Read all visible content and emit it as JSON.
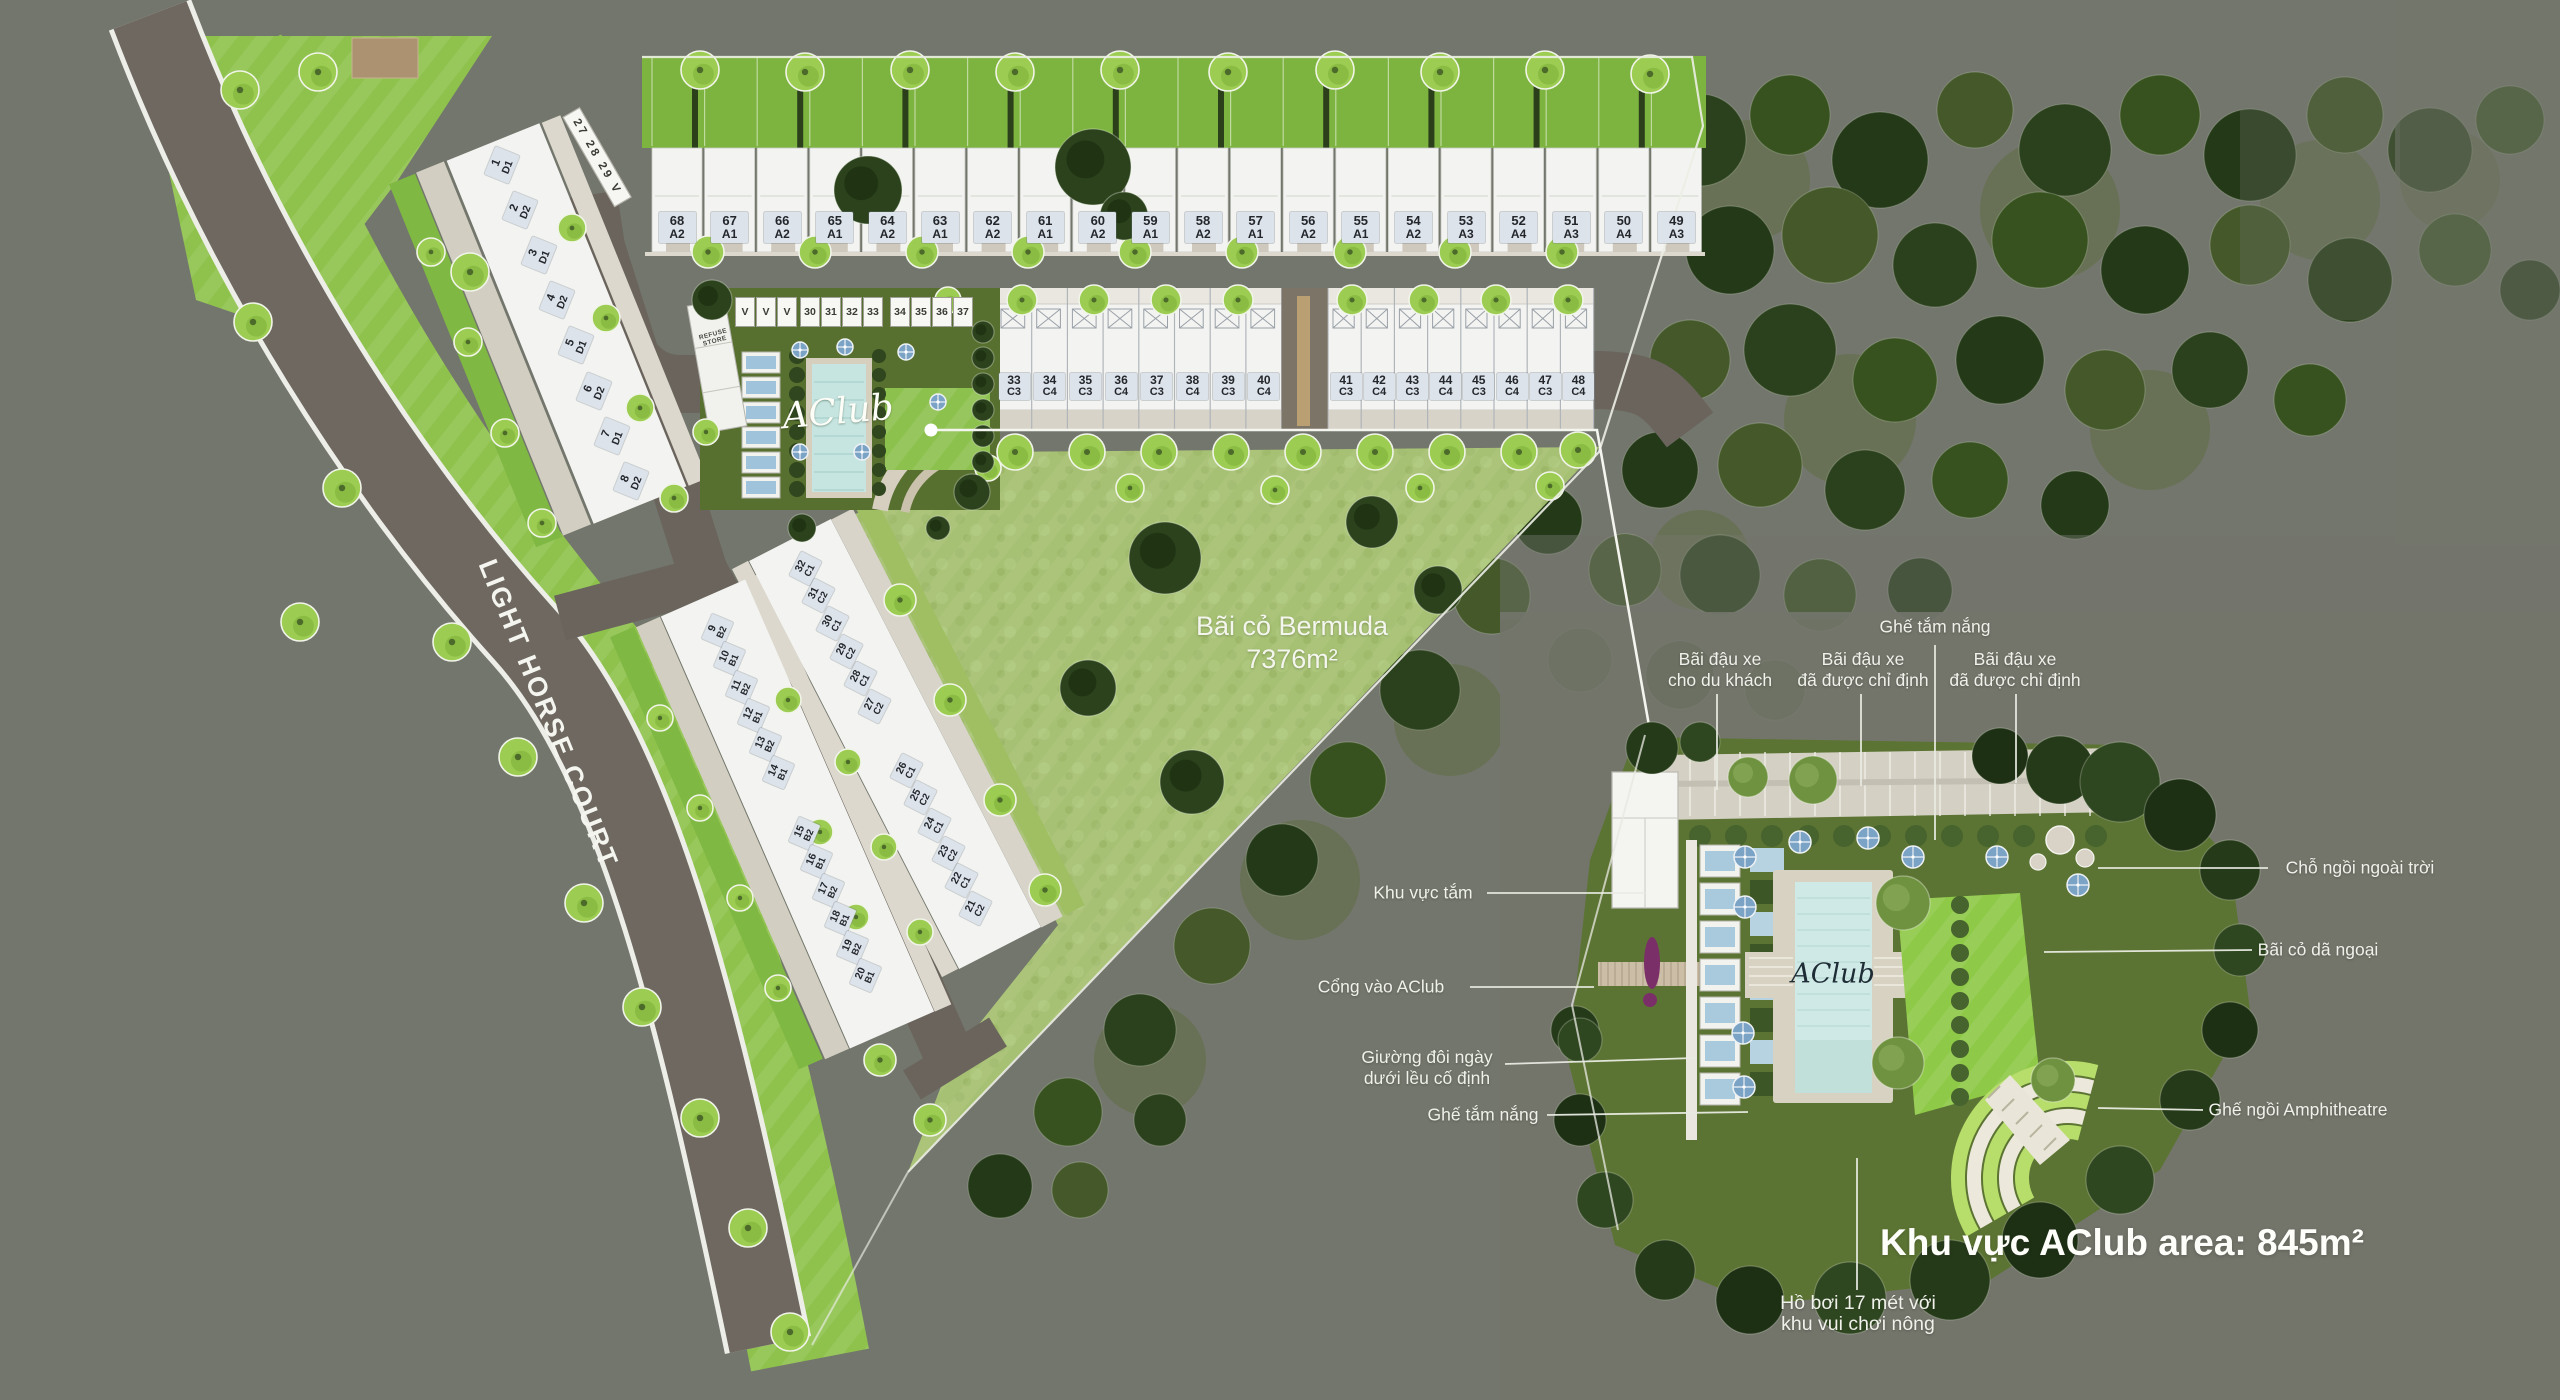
{
  "site": {
    "street_name": "LIGHT HORSE COURT",
    "street_parking_label": "27 28 29 V",
    "lawn": {
      "name": "Bãi cỏ Bermuda",
      "area": "7376m²"
    },
    "club_small": {
      "logo": "AClub",
      "refuse_store_line1": "REFUSE",
      "refuse_store_line2": "STORE",
      "parking_v": [
        "V",
        "V",
        "V"
      ],
      "parking_group1": [
        "30",
        "31",
        "32",
        "33"
      ],
      "parking_group2": [
        "34",
        "35",
        "36",
        "37"
      ]
    },
    "lots": {
      "row_a": [
        {
          "num": "68",
          "type": "A2"
        },
        {
          "num": "67",
          "type": "A1"
        },
        {
          "num": "66",
          "type": "A2"
        },
        {
          "num": "65",
          "type": "A1"
        },
        {
          "num": "64",
          "type": "A2"
        },
        {
          "num": "63",
          "type": "A1"
        },
        {
          "num": "62",
          "type": "A2"
        },
        {
          "num": "61",
          "type": "A1"
        },
        {
          "num": "60",
          "type": "A2"
        },
        {
          "num": "59",
          "type": "A1"
        },
        {
          "num": "58",
          "type": "A2"
        },
        {
          "num": "57",
          "type": "A1"
        },
        {
          "num": "56",
          "type": "A2"
        },
        {
          "num": "55",
          "type": "A1"
        },
        {
          "num": "54",
          "type": "A2"
        },
        {
          "num": "53",
          "type": "A3"
        },
        {
          "num": "52",
          "type": "A4"
        },
        {
          "num": "51",
          "type": "A3"
        },
        {
          "num": "50",
          "type": "A4"
        },
        {
          "num": "49",
          "type": "A3"
        }
      ],
      "row_c_top": [
        {
          "num": "33",
          "type": "C3"
        },
        {
          "num": "34",
          "type": "C4"
        },
        {
          "num": "35",
          "type": "C3"
        },
        {
          "num": "36",
          "type": "C4"
        },
        {
          "num": "37",
          "type": "C3"
        },
        {
          "num": "38",
          "type": "C4"
        },
        {
          "num": "39",
          "type": "C3"
        },
        {
          "num": "40",
          "type": "C4"
        },
        {
          "num": "41",
          "type": "C3"
        },
        {
          "num": "42",
          "type": "C4"
        },
        {
          "num": "43",
          "type": "C3"
        },
        {
          "num": "44",
          "type": "C4"
        },
        {
          "num": "45",
          "type": "C3"
        },
        {
          "num": "46",
          "type": "C4"
        },
        {
          "num": "47",
          "type": "C3"
        },
        {
          "num": "48",
          "type": "C4"
        }
      ],
      "col_d": [
        {
          "num": "1",
          "type": "D1"
        },
        {
          "num": "2",
          "type": "D2"
        },
        {
          "num": "3",
          "type": "D1"
        },
        {
          "num": "4",
          "type": "D2"
        },
        {
          "num": "5",
          "type": "D1"
        },
        {
          "num": "6",
          "type": "D2"
        },
        {
          "num": "7",
          "type": "D1"
        },
        {
          "num": "8",
          "type": "D2"
        }
      ],
      "col_b": [
        {
          "num": "9",
          "type": "B2"
        },
        {
          "num": "10",
          "type": "B1"
        },
        {
          "num": "11",
          "type": "B2"
        },
        {
          "num": "12",
          "type": "B1"
        },
        {
          "num": "13",
          "type": "B2"
        },
        {
          "num": "14",
          "type": "B1"
        },
        {
          "num": "15",
          "type": "B2"
        },
        {
          "num": "16",
          "type": "B1"
        },
        {
          "num": "17",
          "type": "B2"
        },
        {
          "num": "18",
          "type": "B1"
        },
        {
          "num": "19",
          "type": "B2"
        },
        {
          "num": "20",
          "type": "B1"
        }
      ],
      "col_c": [
        {
          "num": "32",
          "type": "C1"
        },
        {
          "num": "31",
          "type": "C2"
        },
        {
          "num": "30",
          "type": "C1"
        },
        {
          "num": "29",
          "type": "C2"
        },
        {
          "num": "28",
          "type": "C1"
        },
        {
          "num": "27",
          "type": "C2"
        },
        {
          "num": "26",
          "type": "C1"
        },
        {
          "num": "25",
          "type": "C2"
        },
        {
          "num": "24",
          "type": "C1"
        },
        {
          "num": "23",
          "type": "C2"
        },
        {
          "num": "22",
          "type": "C1"
        },
        {
          "num": "21",
          "type": "C2"
        }
      ]
    }
  },
  "detail": {
    "logo": "AClub",
    "area_title": "Khu vực AClub area: 845m²",
    "callouts": {
      "sun_loungers_top": "Ghế tắm nắng",
      "visitor_parking": [
        "Bãi đậu xe",
        "cho du khách"
      ],
      "assigned_parking_1": [
        "Bãi đậu xe",
        "đã được chỉ định"
      ],
      "assigned_parking_2": [
        "Bãi đậu xe",
        "đã được chỉ định"
      ],
      "bath_area": "Khu vực tắm",
      "club_entrance": "Cổng vào AClub",
      "daybed": [
        "Giường đôi ngày",
        "dưới lều cố định"
      ],
      "sun_loungers_left": "Ghế tắm nắng",
      "outdoor_seating": "Chỗ ngồi ngoài trời",
      "picnic_lawn": "Bãi cỏ dã ngoại",
      "amphitheatre": "Ghế ngồi Amphitheatre",
      "pool": [
        "Hồ bơi 17 mét với",
        "khu vui chơi nông"
      ]
    }
  }
}
